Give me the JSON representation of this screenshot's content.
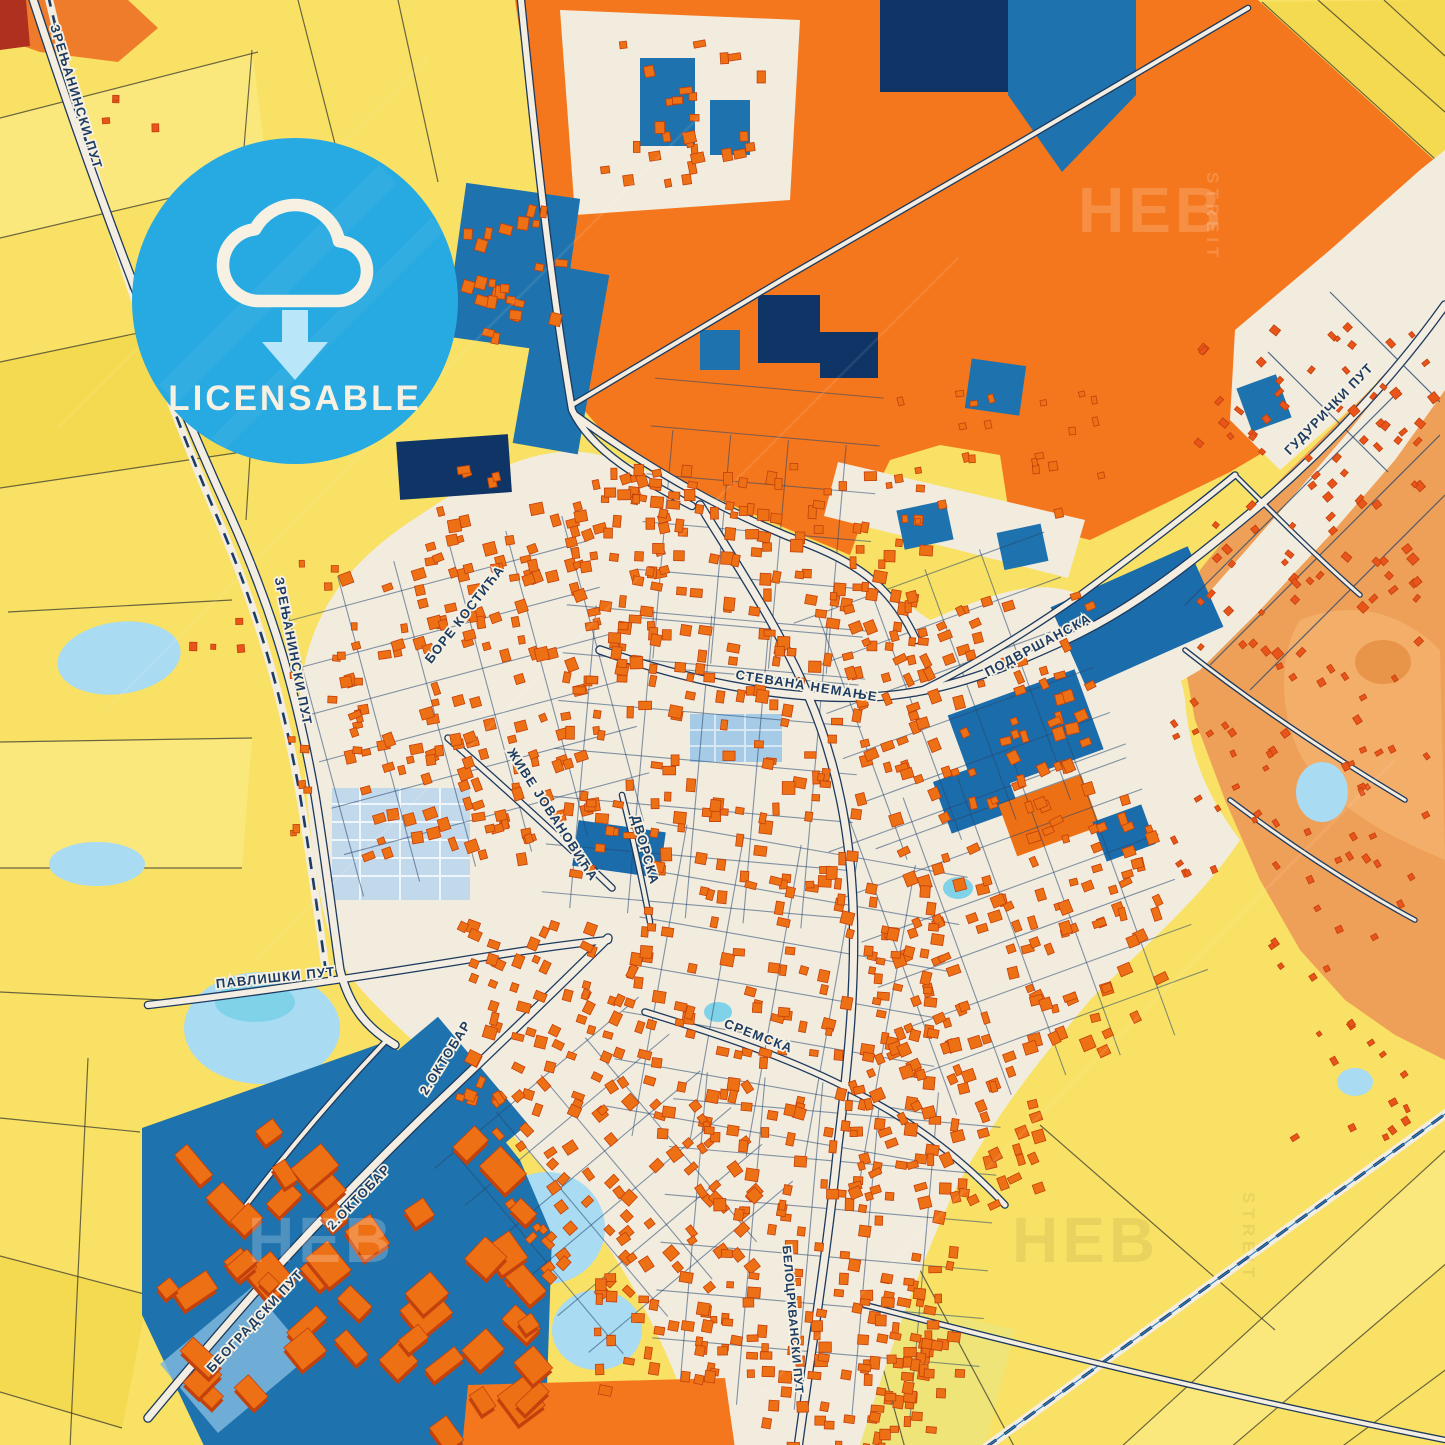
{
  "badge": {
    "label": "LICENSABLE"
  },
  "watermark": {
    "word_main": "HEB",
    "word_sub": "STREIT"
  },
  "streets": [
    {
      "id": "zrenjaninski-top",
      "text": "ЗРЕЊАНИНСКИ ПУТ"
    },
    {
      "id": "zrenjaninski-mid",
      "text": "ЗРЕЊАНИНСКИ ПУТ"
    },
    {
      "id": "bore-kostica",
      "text": "БОРЕ КОСТИЋА"
    },
    {
      "id": "stevana-nemanje",
      "text": "СТЕВАНА НЕМАЊЕ"
    },
    {
      "id": "podvrsanska",
      "text": "ПОДВРШАНСКА"
    },
    {
      "id": "guduricki-put",
      "text": "ГУДУРИЧКИ ПУТ"
    },
    {
      "id": "zive-jovanovica",
      "text": "ЖИВЕ ЈОВАНОВИЋА"
    },
    {
      "id": "dvorska",
      "text": "ДВОРСКА"
    },
    {
      "id": "pavliski-put",
      "text": "ПАВЛИШКИ ПУТ"
    },
    {
      "id": "sremska",
      "text": "СРЕМСКА"
    },
    {
      "id": "oktobar-upper",
      "text": "2.ОКТОБАР"
    },
    {
      "id": "oktobar-lower",
      "text": "2.ОКТОБАР"
    },
    {
      "id": "beogradski-put",
      "text": "БЕОГРАДСКИ ПУТ"
    },
    {
      "id": "belocrkvanski-put",
      "text": "БЕЛОЦРКВАНСКИ ПУТ"
    }
  ],
  "colors": {
    "field_yellow": "#f8e164",
    "field_orange": "#f4771d",
    "terrain_orange": "#efa058",
    "urban_cream": "#f2ecdf",
    "zone_blue": "#1e72ad",
    "zone_navy": "#0e3566",
    "water_blue": "#a9dbf2",
    "water_cyan": "#7fd2e8",
    "building": "#ee7014",
    "building_shadow": "#c2410c",
    "house_red": "#e8541a",
    "road_fill": "#f3eee1",
    "road_casing": "#1d3a5e",
    "label_navy": "#1d3c63",
    "badge_blue": "#27a9e1",
    "badge_cream": "#f6f1e3",
    "badge_arrow": "#b9e6f8"
  }
}
